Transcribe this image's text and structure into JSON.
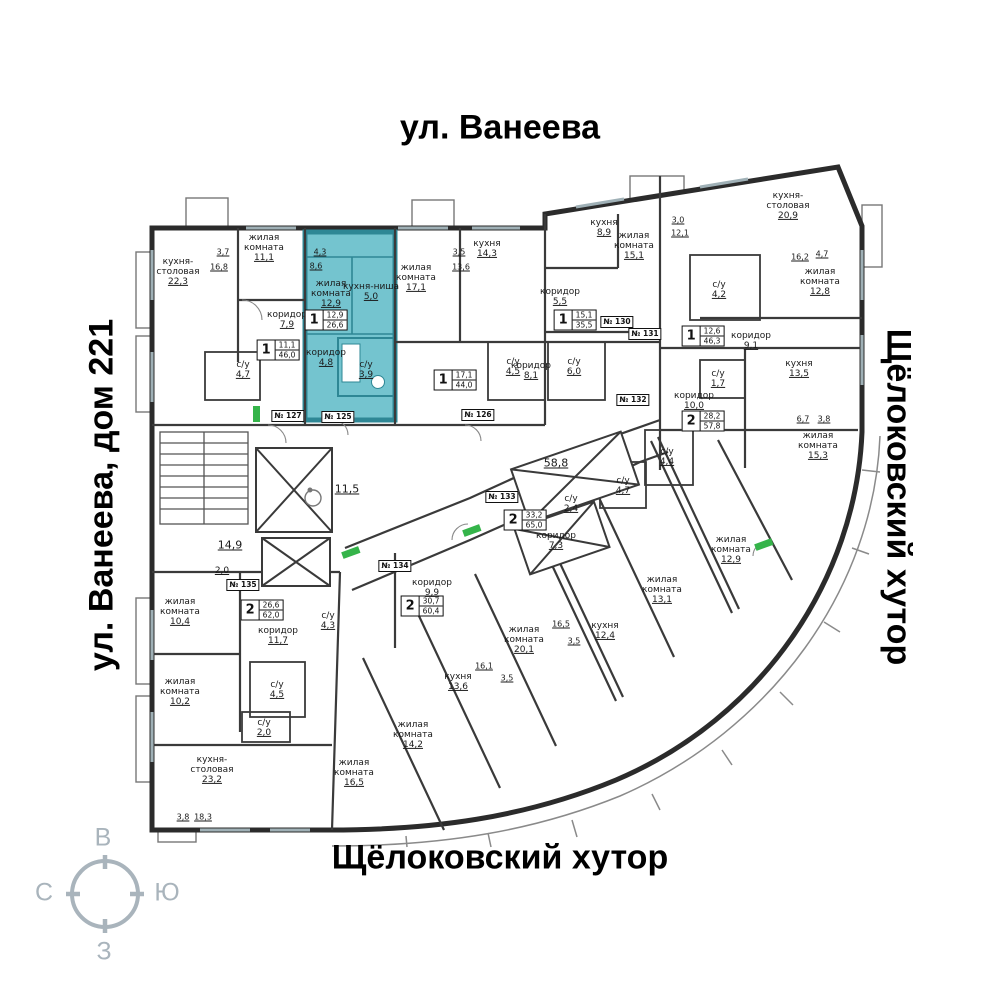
{
  "streets": {
    "top": "ул. Ванеева",
    "left": "ул. Ванеева, дом 221",
    "right": "Щёлоковский хутор",
    "bottom": "Щёлоковский хутор"
  },
  "compass": {
    "top": "В",
    "right": "Ю",
    "bottom": "З",
    "left": "С"
  },
  "colors": {
    "highlight_fill": "#74c4cf",
    "highlight_wall": "#2e8795",
    "wall": "#2b2b2b",
    "door_marker": "#35b44a",
    "compass": "#a9b4bc"
  },
  "common_areas": {
    "stairs": "14,9",
    "landing": "2,0",
    "lobby": "11,5",
    "corridor_total": "58,8"
  },
  "apartments": [
    {
      "plate": "№ 127",
      "badge": {
        "rooms": "1",
        "living": "11,1",
        "total": "46,0"
      },
      "rooms": [
        {
          "name": "кухня-столовая",
          "area": "22,3"
        },
        {
          "name": "жилая комната",
          "area": "11,1"
        },
        {
          "name": "коридор",
          "area": "7,9"
        },
        {
          "name": "с/у",
          "area": "4,7"
        }
      ],
      "dims": [
        "3,7",
        "16,8"
      ]
    },
    {
      "plate": "№ 125",
      "highlighted": true,
      "badge": {
        "rooms": "1",
        "living": "12,9",
        "total": "26,6"
      },
      "rooms": [
        {
          "name": "жилая комната",
          "area": "12,9"
        },
        {
          "name": "кухня-ниша",
          "area": "5,0"
        },
        {
          "name": "коридор",
          "area": "4,8"
        },
        {
          "name": "с/у",
          "area": "3,9"
        }
      ],
      "dims": [
        "4,3",
        "8,6"
      ]
    },
    {
      "plate": "№ 126",
      "badge": {
        "rooms": "1",
        "living": "17,1",
        "total": "44,0"
      },
      "rooms": [
        {
          "name": "жилая комната",
          "area": "17,1"
        },
        {
          "name": "кухня",
          "area": "14,3"
        },
        {
          "name": "коридор",
          "area": "8,1"
        },
        {
          "name": "с/у",
          "area": "4,5"
        }
      ],
      "dims": [
        "3,5",
        "13,6"
      ]
    },
    {
      "plate": "№ 130",
      "badge": {
        "rooms": "1",
        "living": "15,1",
        "total": "35,5"
      },
      "rooms": [
        {
          "name": "кухня",
          "area": "8,9"
        },
        {
          "name": "жилая комната",
          "area": "15,1"
        },
        {
          "name": "коридор",
          "area": "5,5"
        },
        {
          "name": "с/у",
          "area": "6,0"
        }
      ],
      "dims": [
        "3,0",
        "12,1"
      ]
    },
    {
      "plate": "№ 131",
      "badge": {
        "rooms": "1",
        "living": "12,6",
        "total": "46,3"
      },
      "rooms": [
        {
          "name": "кухня-столовая",
          "area": "20,9"
        },
        {
          "name": "жилая комната",
          "area": "12,8"
        },
        {
          "name": "коридор",
          "area": "9,1"
        },
        {
          "name": "с/у",
          "area": "4,2"
        }
      ],
      "dims": [
        "16,2",
        "4,7"
      ]
    },
    {
      "plate": "№ 132",
      "badge": {
        "rooms": "2",
        "living": "28,2",
        "total": "57,8"
      },
      "rooms": [
        {
          "name": "кухня",
          "area": "13,5"
        },
        {
          "name": "коридор",
          "area": "10,0"
        },
        {
          "name": "с/у",
          "area": "1,7"
        },
        {
          "name": "с/у",
          "area": "4,4"
        },
        {
          "name": "жилая комната",
          "area": "15,3"
        },
        {
          "name": "жилая комната",
          "area": "12,9"
        }
      ],
      "dims": [
        "6,7",
        "3,8"
      ]
    },
    {
      "plate": "№ 133",
      "badge": {
        "rooms": "2",
        "living": "33,2",
        "total": "65,0"
      },
      "rooms": [
        {
          "name": "с/у",
          "area": "2,4"
        },
        {
          "name": "с/у",
          "area": "4,7"
        },
        {
          "name": "коридор",
          "area": "7,3"
        },
        {
          "name": "жилая комната",
          "area": "13,1"
        },
        {
          "name": "кухня",
          "area": "12,4"
        }
      ],
      "dims": [
        "16,5",
        "3,5"
      ]
    },
    {
      "plate": "№ 134",
      "badge": {
        "rooms": "2",
        "living": "30,7",
        "total": "60,4"
      },
      "rooms": [
        {
          "name": "коридор",
          "area": "9,9"
        },
        {
          "name": "жилая комната",
          "area": "20,1"
        },
        {
          "name": "кухня",
          "area": "13,6"
        },
        {
          "name": "жилая комната",
          "area": "14,2"
        },
        {
          "name": "с/у",
          "area": "4,3"
        }
      ],
      "dims": [
        "16,1",
        "3,5"
      ]
    },
    {
      "plate": "№ 135",
      "badge": {
        "rooms": "2",
        "living": "26,6",
        "total": "62,0"
      },
      "rooms": [
        {
          "name": "жилая комната",
          "area": "10,4"
        },
        {
          "name": "коридор",
          "area": "11,7"
        },
        {
          "name": "жилая комната",
          "area": "10,2"
        },
        {
          "name": "с/у",
          "area": "4,5"
        },
        {
          "name": "с/у",
          "area": "2,0"
        },
        {
          "name": "кухня-столовая",
          "area": "23,2"
        },
        {
          "name": "жилая комната",
          "area": "16,5"
        }
      ],
      "dims": [
        "3,8",
        "18,3"
      ]
    }
  ]
}
